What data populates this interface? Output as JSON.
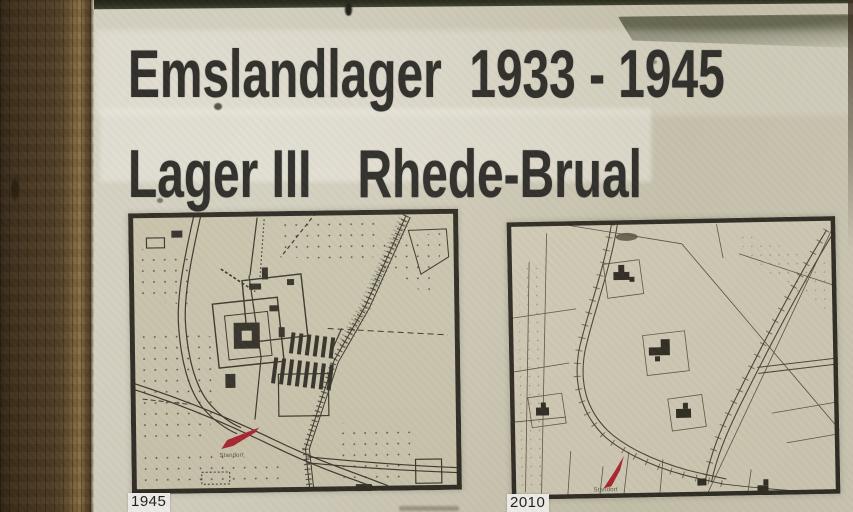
{
  "sign": {
    "title": {
      "line1_left": "Emslandlager",
      "line1_right": "1933 - 1945",
      "line2_left": "Lager III",
      "line2_right": "Rhede-Brual"
    },
    "maps": [
      {
        "year_label": "1945",
        "marker_label": "Standort"
      },
      {
        "year_label": "2010",
        "marker_label": "Standort"
      }
    ],
    "colors": {
      "board_beige": "#d2cdba",
      "map_paper_1945": "#cbc5ae",
      "map_paper_2010": "#d0cab5",
      "title_ink": "#2d2c28",
      "map_line_ink": "#3a372c",
      "marker_red": "#aa2430",
      "wood_post_dark": "#46351f",
      "wood_post_light": "#8d7244",
      "label_box_white": "#f3f2ed",
      "top_edge_dark": "#2a2d1d"
    }
  }
}
